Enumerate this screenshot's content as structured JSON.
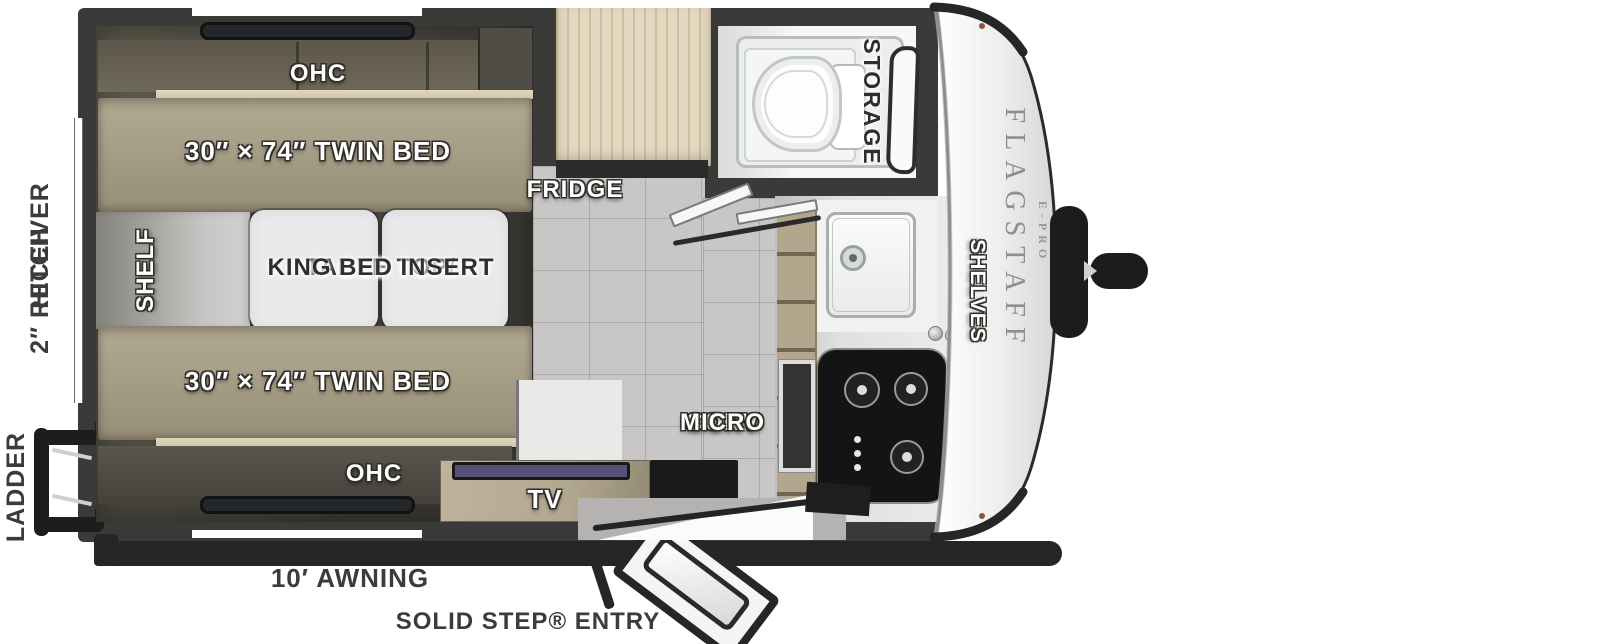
{
  "title": "Flagstaff E-Pro travel trailer floorplan",
  "branding": {
    "model": "FLAGSTAFF",
    "series": "E-PRO"
  },
  "rooms": {
    "bedroom": {
      "ohc_top": "OHC",
      "ohc_bottom": "OHC",
      "twin_bed_top": "30″ × 74″ TWIN BED",
      "twin_bed_bottom": "30″ × 74″ TWIN BED",
      "shelf": "SHELF",
      "table_line1": "TABLE TOP/",
      "table_line2": "KING BED INSERT",
      "tv": "TV"
    },
    "kitchen": {
      "fridge": "FRIDGE",
      "conv_line1": "CONV",
      "conv_line2": "MICRO",
      "shelves": "SHELVES"
    },
    "bathroom": {
      "storage": "STORAGE"
    }
  },
  "exterior": {
    "receiver_hitch_line1": "2″ RECEIVER",
    "receiver_hitch_line2": "HITCH",
    "ladder": "LADDER",
    "awning": "10′ AWNING",
    "entry": "SOLID STEP® ENTRY"
  },
  "colors": {
    "wall": "#3a3a38",
    "bedroomA": "#615d52",
    "bedroomB": "#3b3935",
    "mattress": "#a89f88",
    "cushion": "#6f6959",
    "woodstrip": "#cfc6ad",
    "fridgewood": "#e3d7bf",
    "cabinetwood": "#b4a68c",
    "tvwood": "#b2a890",
    "table": "#e9e9eb",
    "tile": "#c9c7c5",
    "counter": "#e0e0e0",
    "cooktop": "#141414",
    "cap": "#f5f5f5",
    "trim": "#262626",
    "screen": "#565178",
    "labeldark": "#3b3b3b"
  }
}
